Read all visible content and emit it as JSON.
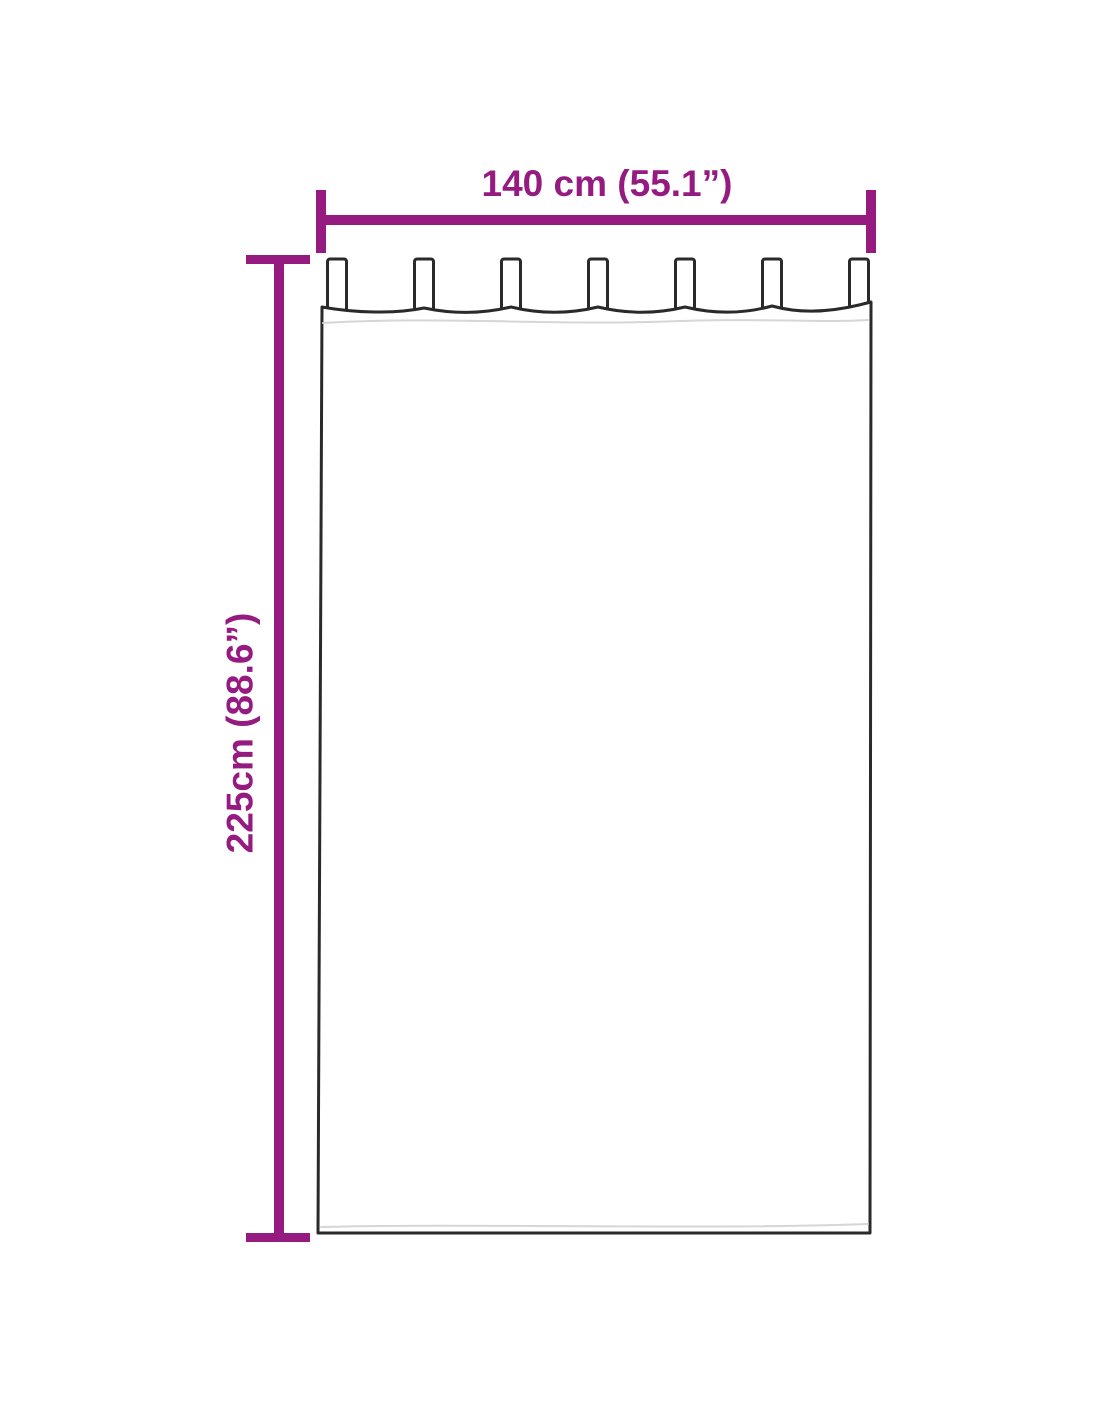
{
  "page": {
    "background": "#ffffff"
  },
  "diagram": {
    "type": "curtain-dimension-diagram",
    "subject": "tab-top curtain panel, front outline view",
    "width_label": "140 cm (55.1”)",
    "height_label": "225cm (88.6”)",
    "tab_count": 7,
    "colors": {
      "dimension_accent": "#951b81",
      "curtain_outline": "#2a2a2a",
      "curtain_fill": "#ffffff",
      "seam_line": "#d6d6d6"
    }
  }
}
